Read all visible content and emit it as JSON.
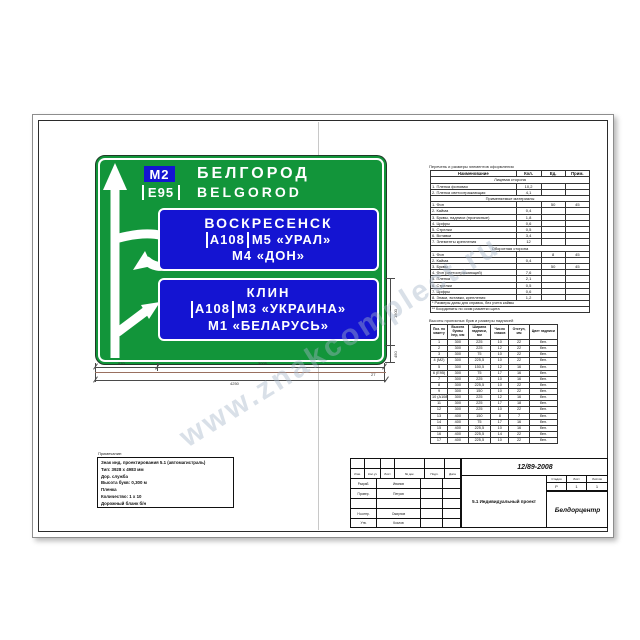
{
  "watermark": "www.znakcomplect.ru",
  "sign": {
    "badge": "М2",
    "city": "БЕЛГОРОД",
    "euro": "Е95",
    "city_lat": "BELGOROD",
    "panel1": {
      "line1": "ВОСКРЕСЕНСК",
      "route": "А108",
      "line2": "М5 «УРАЛ»",
      "line3": "М4 «ДОН»"
    },
    "panel2": {
      "line1": "КЛИН",
      "route": "А108",
      "line2": "М3 «УКРАИНА»",
      "line3": "М1 «БЕЛАРУСЬ»"
    },
    "colors": {
      "green": "#12953a",
      "blue": "#1414d2",
      "white": "#ffffff"
    }
  },
  "dimensions": {
    "seg1": "870",
    "seg2": "3005",
    "total": "4250",
    "right_top": "1500",
    "right_bottom": "450",
    "corner_note": "27"
  },
  "table1": {
    "caption": "Перечень и размеры элементов оформления",
    "headers": [
      "Наименование",
      "Кол.",
      "Ед.",
      "Прим."
    ],
    "rows": [
      "Лицевая сторона",
      [
        "1. Пленка фоновая",
        "10,2",
        "",
        ""
      ],
      [
        "2. Пленка светоотражающая",
        "4,1",
        "",
        ""
      ],
      "Применяемые материалы",
      [
        "1. Фон",
        "",
        "50",
        "45"
      ],
      [
        "2. Кайма",
        "0,4",
        "",
        ""
      ],
      [
        "3. Буквы, надписи (прописные)",
        "1,8",
        "",
        ""
      ],
      [
        "4. Цифры",
        "0,6",
        "",
        ""
      ],
      [
        "5. Стрелки",
        "0,5",
        "",
        ""
      ],
      [
        "6. Вставки",
        "3,4",
        "",
        ""
      ],
      [
        "7. Элементы крепления",
        "12",
        "",
        ""
      ],
      "Оборотная сторона",
      [
        "1. Фон",
        "",
        "8",
        "45"
      ],
      [
        "2. Кайма",
        "0,4",
        "",
        ""
      ],
      [
        "3. Буквы",
        "",
        "50",
        "45"
      ],
      [
        "4. Фон (светоотражающий)",
        "7,6",
        "",
        ""
      ],
      [
        "5. Пленка",
        "2,1",
        "",
        ""
      ],
      [
        "6. Стрелки",
        "0,5",
        "",
        ""
      ],
      [
        "7. Цифры",
        "0,6",
        "",
        ""
      ],
      [
        "8. Знаки, вставки, крепления",
        "1,2",
        "",
        ""
      ]
    ],
    "notes": [
      "* Размеры даны для справок, без учета каймы",
      "** Координаты по осям разметки щита"
    ]
  },
  "table2": {
    "caption": "Высоты прописных букв и размеры надписей",
    "headers": [
      "Поз. по макету",
      "Высота буквы hпр, мм",
      "Ширина надписи, мм",
      "Число знаков",
      "Отступ, мм",
      "Цвет надписи"
    ],
    "rows": [
      [
        "1",
        "300",
        "225",
        "10",
        "22",
        "бел."
      ],
      [
        "2",
        "300",
        "225",
        "12",
        "22",
        "бел."
      ],
      [
        "3",
        "300",
        "75",
        "10",
        "22",
        "бел."
      ],
      [
        "4 (М2)",
        "300",
        "225,5",
        "10",
        "22",
        "бел."
      ],
      [
        "5",
        "300",
        "150,5",
        "12",
        "16",
        "бел."
      ],
      [
        "6 (Е95)",
        "300",
        "75",
        "17",
        "16",
        "бел."
      ],
      [
        "7",
        "300",
        "225",
        "10",
        "16",
        "бел."
      ],
      [
        "8",
        "300",
        "225,5",
        "10",
        "22",
        "бел."
      ],
      [
        "9",
        "300",
        "150",
        "10",
        "22",
        "бел."
      ],
      [
        "10 (А108)",
        "300",
        "225",
        "12",
        "16",
        "бел."
      ],
      [
        "11",
        "300",
        "225",
        "17",
        "18",
        "бел."
      ],
      [
        "12",
        "300",
        "225",
        "10",
        "22",
        "бел."
      ],
      [
        "13",
        "400",
        "150",
        "8",
        "7",
        "бел."
      ],
      [
        "14",
        "400",
        "75",
        "17",
        "16",
        "бел."
      ],
      [
        "15",
        "400",
        "225,5",
        "10",
        "16",
        "бел."
      ],
      [
        "16",
        "400",
        "225,5",
        "14",
        "22",
        "бел."
      ],
      [
        "17",
        "400",
        "225,5",
        "10",
        "22",
        "бел."
      ]
    ]
  },
  "notes_block": {
    "caption": "Примечание:",
    "lines": [
      "Знак инд. проектирования 5.1 (автомагистраль)",
      "Тип: 3928 х 4983 мм",
      "Дор. служба",
      "Высота букв: 0,300 м",
      "Пленка",
      "Количество: 1 х 10",
      "Дорожный бланк б/н"
    ]
  },
  "titleblock": {
    "doc_number": "12/89-2008",
    "title": "5.1 Индивидуальный проект",
    "org": "Белдорцентр",
    "header_cells": [
      "Изм.",
      "Кол.уч",
      "Лист",
      "№ док.",
      "Подп.",
      "Дата"
    ],
    "sign_rows": [
      [
        "Разраб.",
        "Иванов"
      ],
      [
        "Провер.",
        "Петров"
      ],
      [
        "",
        ""
      ],
      [
        "Н.контр.",
        "Смирнов"
      ],
      [
        "Утв.",
        "Козлов"
      ]
    ],
    "stage_labels": [
      "Стадия",
      "Лист",
      "Листов"
    ],
    "stage_values": [
      "Р",
      "1",
      "1"
    ]
  }
}
